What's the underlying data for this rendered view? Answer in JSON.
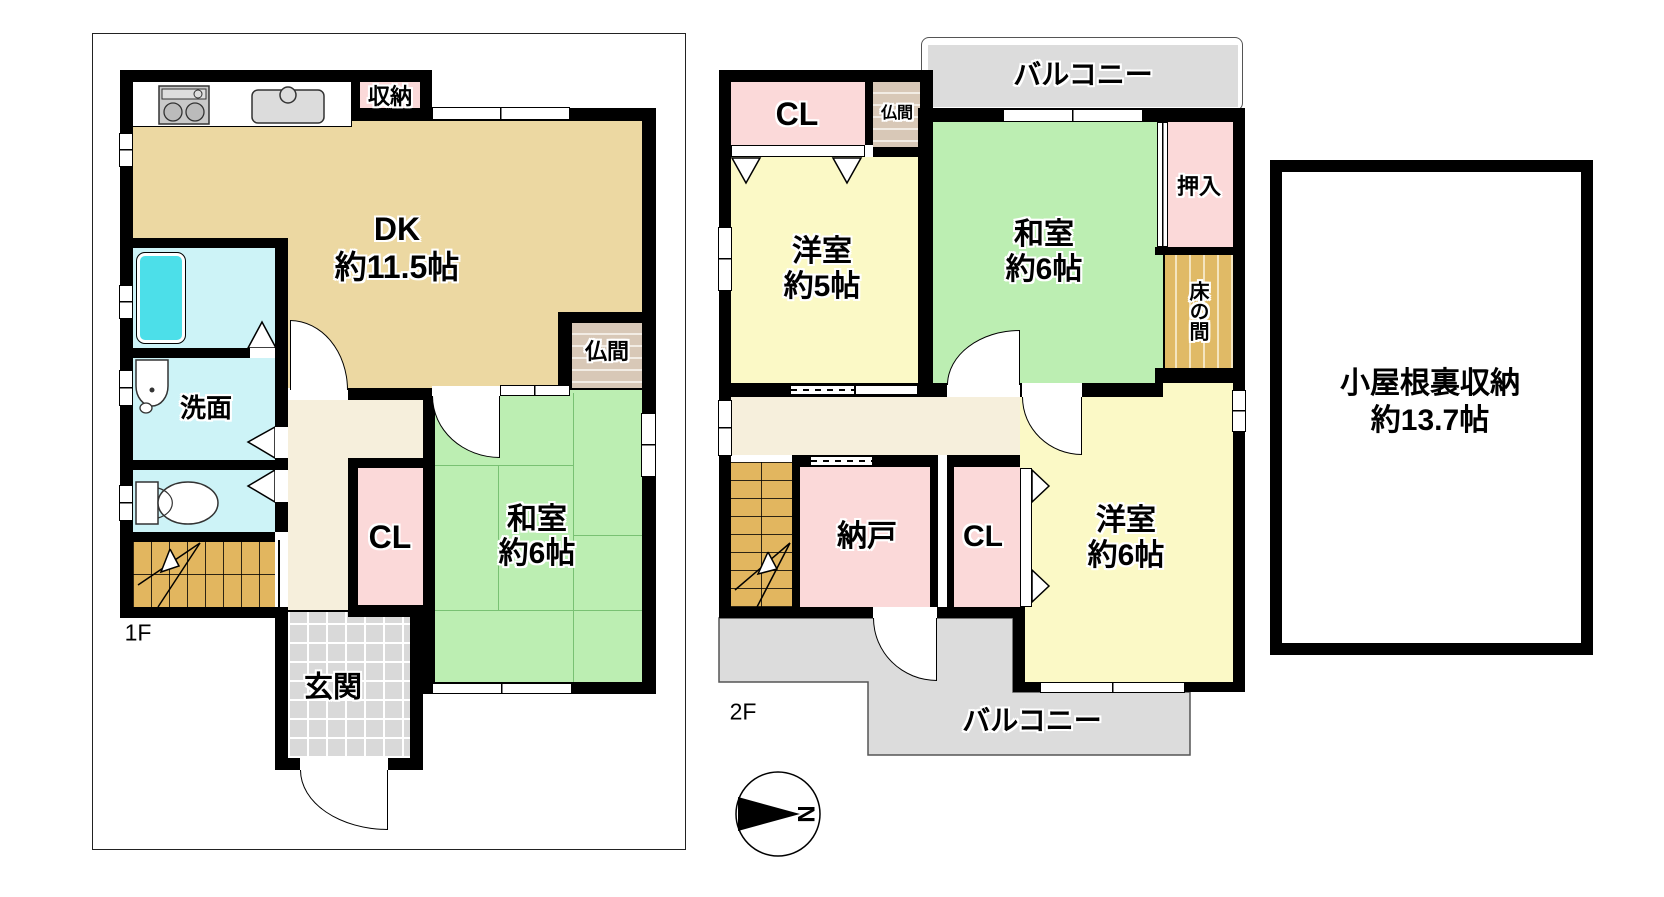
{
  "palette": {
    "wall": "#000000",
    "dk_tan": "#ecd8a2",
    "tatami_green": "#bceeb2",
    "western_yellow": "#fbf9c6",
    "closet_pink": "#fbd9d9",
    "wet_area_cyan": "#cdf3f7",
    "bathtub_cyan": "#4cdfe9",
    "stairs_gold": "#e2b65f",
    "tokonoma_gold": "#e0ba66",
    "hall_cream": "#f6efdc",
    "tile_gray": "#d9d9d9",
    "balcony_gray": "#dcdcdc",
    "butsuma_beige": "#d8c8b7"
  },
  "floor1": {
    "floor_label": "1F",
    "dk": {
      "name": "DK",
      "size": "約11.5帖"
    },
    "washitsu": {
      "name": "和室",
      "size": "約6帖"
    },
    "senmen": {
      "name": "洗面"
    },
    "closet": {
      "name": "CL"
    },
    "genkan": {
      "name": "玄関"
    },
    "shuno": {
      "name": "収納"
    },
    "butsuma": {
      "name": "仏間"
    }
  },
  "floor2": {
    "floor_label": "2F",
    "yoshitsu5": {
      "name": "洋室",
      "size": "約5帖"
    },
    "washitsu6": {
      "name": "和室",
      "size": "約6帖"
    },
    "yoshitsu6": {
      "name": "洋室",
      "size": "約6帖"
    },
    "nando": {
      "name": "納戸"
    },
    "closet_top": {
      "name": "CL"
    },
    "closet_bottom": {
      "name": "CL"
    },
    "oshiire": {
      "name": "押入"
    },
    "tokonoma": {
      "name": "床の間"
    },
    "butsuma": {
      "name": "仏間"
    },
    "balcony_top": {
      "name": "バルコニー"
    },
    "balcony_bottom": {
      "name": "バルコニー"
    }
  },
  "attic": {
    "name": "小屋根裏収納",
    "size": "約13.7帖"
  },
  "compass": {
    "north": "N"
  }
}
